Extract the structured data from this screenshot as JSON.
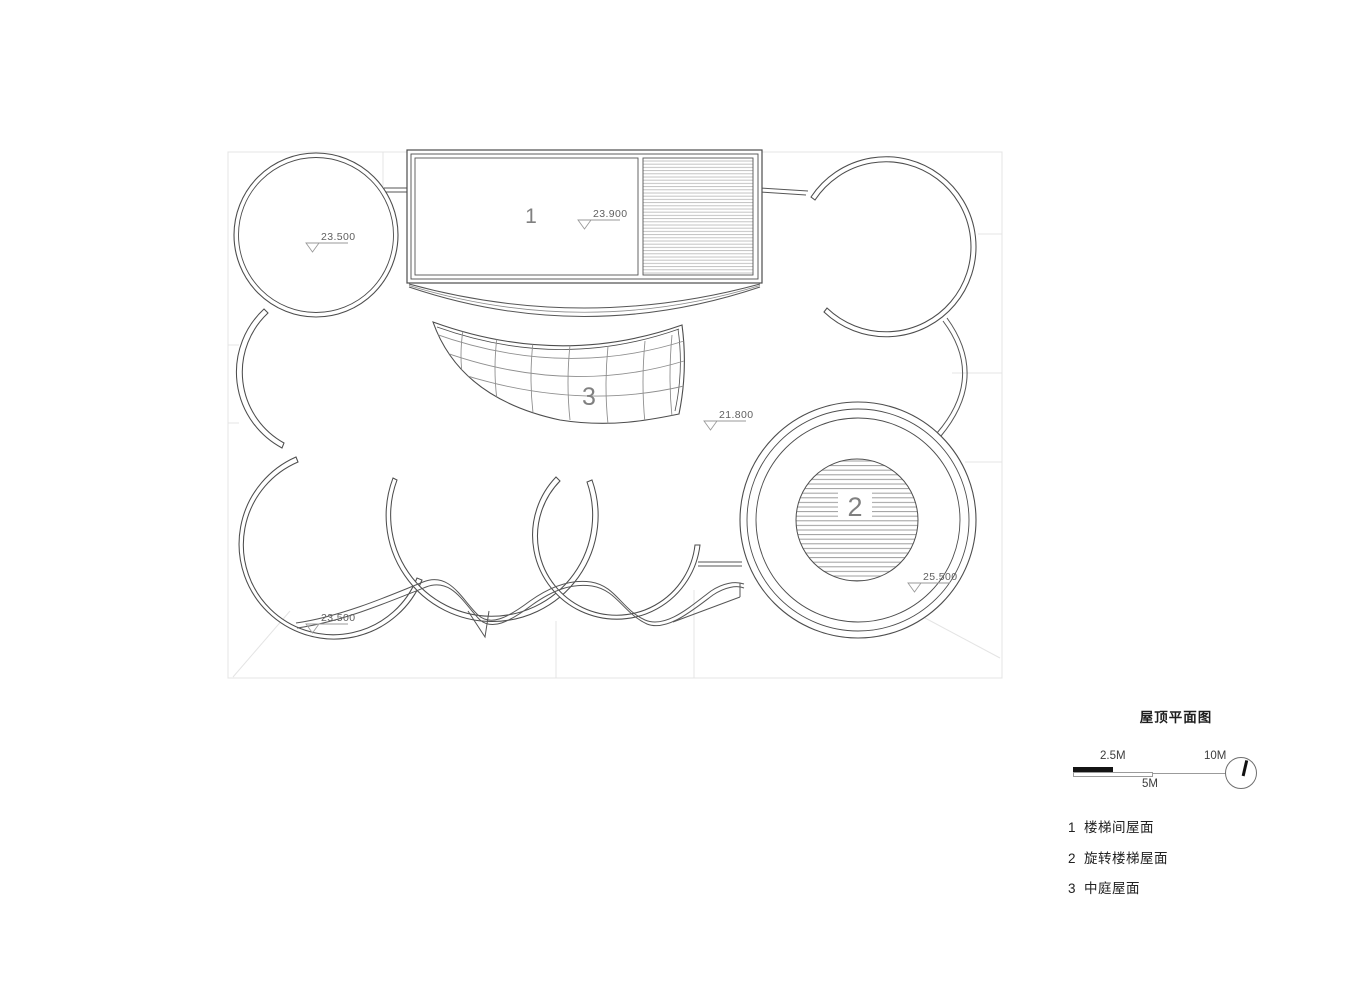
{
  "plan": {
    "roof_labels": {
      "stair_block": "1",
      "spiral_stair": "2",
      "atrium": "3"
    },
    "elevations": {
      "top_left_circle": "23.500",
      "stair_block": "23.900",
      "atrium": "21.800",
      "spiral_stair": "25.500",
      "bottom_left": "23.500"
    }
  },
  "legend": {
    "title": "屋顶平面图",
    "scale": {
      "left": "2.5M",
      "mid": "5M",
      "right": "10M"
    },
    "items": [
      {
        "num": "1",
        "label": "楼梯间屋面"
      },
      {
        "num": "2",
        "label": "旋转楼梯屋面"
      },
      {
        "num": "3",
        "label": "中庭屋面"
      }
    ]
  },
  "colors": {
    "line": "#4d4d4d",
    "hatch": "#a8a8a8",
    "faint": "#e4e4e4",
    "marker": "#9a9a9a",
    "scalebar_fill": "#141414",
    "background": "#ffffff"
  }
}
